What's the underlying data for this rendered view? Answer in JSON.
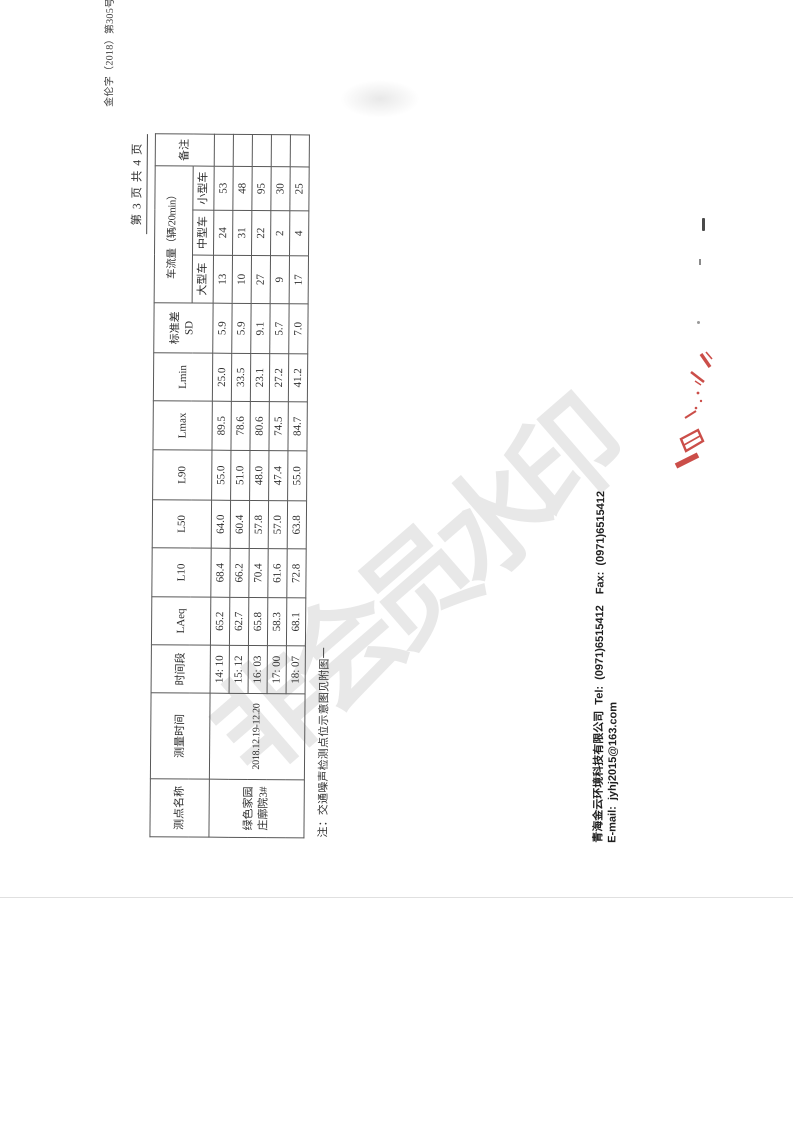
{
  "document": {
    "doc_number": "金伦字（2018）第305号",
    "page_indicator": "第 3 页 共 4 页",
    "note": "注：交通噪声检测点位示意图见附图一",
    "footer": {
      "company_line": "青海金云环境科技有限公司 Tel: (0971)6515412　Fax: (0971)6515412",
      "email_line": "E-mail: jyhj2015@163.com"
    },
    "watermark_text": "非会员水印",
    "stamp_color": "#c43631",
    "paper_color": "#ffffff"
  },
  "table": {
    "header": {
      "site": "测点名称",
      "time": "测量时间",
      "period": "时间段",
      "laeq": "LAeq",
      "l10": "L10",
      "l50": "L50",
      "l90": "L90",
      "lmax": "Lmax",
      "lmin": "Lmin",
      "sd1": "标准差",
      "sd2": "SD",
      "traffic_group": "车流量（辆/20min）",
      "large": "大型车",
      "medium": "中型车",
      "small": "小型车",
      "remark": "备注"
    },
    "site_line1": "绿色家园",
    "site_line2": "庄廓院3#",
    "date_range": "2018.12.19-12.20",
    "rows": [
      {
        "period": "14: 10",
        "laeq": "65.2",
        "l10": "68.4",
        "l50": "64.0",
        "l90": "55.0",
        "lmax": "89.5",
        "lmin": "25.0",
        "sd": "5.9",
        "large": "13",
        "medium": "24",
        "small": "53",
        "remark": ""
      },
      {
        "period": "15: 12",
        "laeq": "62.7",
        "l10": "66.2",
        "l50": "60.4",
        "l90": "51.0",
        "lmax": "78.6",
        "lmin": "33.5",
        "sd": "5.9",
        "large": "10",
        "medium": "31",
        "small": "48",
        "remark": ""
      },
      {
        "period": "16: 03",
        "laeq": "65.8",
        "l10": "70.4",
        "l50": "57.8",
        "l90": "48.0",
        "lmax": "80.6",
        "lmin": "23.1",
        "sd": "9.1",
        "large": "27",
        "medium": "22",
        "small": "95",
        "remark": ""
      },
      {
        "period": "17: 00",
        "laeq": "58.3",
        "l10": "61.6",
        "l50": "57.0",
        "l90": "47.4",
        "lmax": "74.5",
        "lmin": "27.2",
        "sd": "5.7",
        "large": "9",
        "medium": "2",
        "small": "30",
        "remark": ""
      },
      {
        "period": "18: 07",
        "laeq": "68.1",
        "l10": "72.8",
        "l50": "63.8",
        "l90": "55.0",
        "lmax": "84.7",
        "lmin": "41.2",
        "sd": "7.0",
        "large": "17",
        "medium": "4",
        "small": "25",
        "remark": ""
      }
    ]
  },
  "chart_data": {
    "type": "table",
    "title": "交通噪声监测结果（绿色家园庄廓院3#，2018.12.19-12.20）",
    "columns": [
      "时间段",
      "LAeq",
      "L10",
      "L50",
      "L90",
      "Lmax",
      "Lmin",
      "标准差SD",
      "大型车",
      "中型车",
      "小型车"
    ],
    "rows": [
      [
        "14:10",
        65.2,
        68.4,
        64.0,
        55.0,
        89.5,
        25.0,
        5.9,
        13,
        24,
        53
      ],
      [
        "15:12",
        62.7,
        66.2,
        60.4,
        51.0,
        78.6,
        33.5,
        5.9,
        10,
        31,
        48
      ],
      [
        "16:03",
        65.8,
        70.4,
        57.8,
        48.0,
        80.6,
        23.1,
        9.1,
        27,
        22,
        95
      ],
      [
        "17:00",
        58.3,
        61.6,
        57.0,
        47.4,
        74.5,
        27.2,
        5.7,
        9,
        2,
        30
      ],
      [
        "18:07",
        68.1,
        72.8,
        63.8,
        55.0,
        84.7,
        41.2,
        7.0,
        17,
        4,
        25
      ]
    ]
  }
}
